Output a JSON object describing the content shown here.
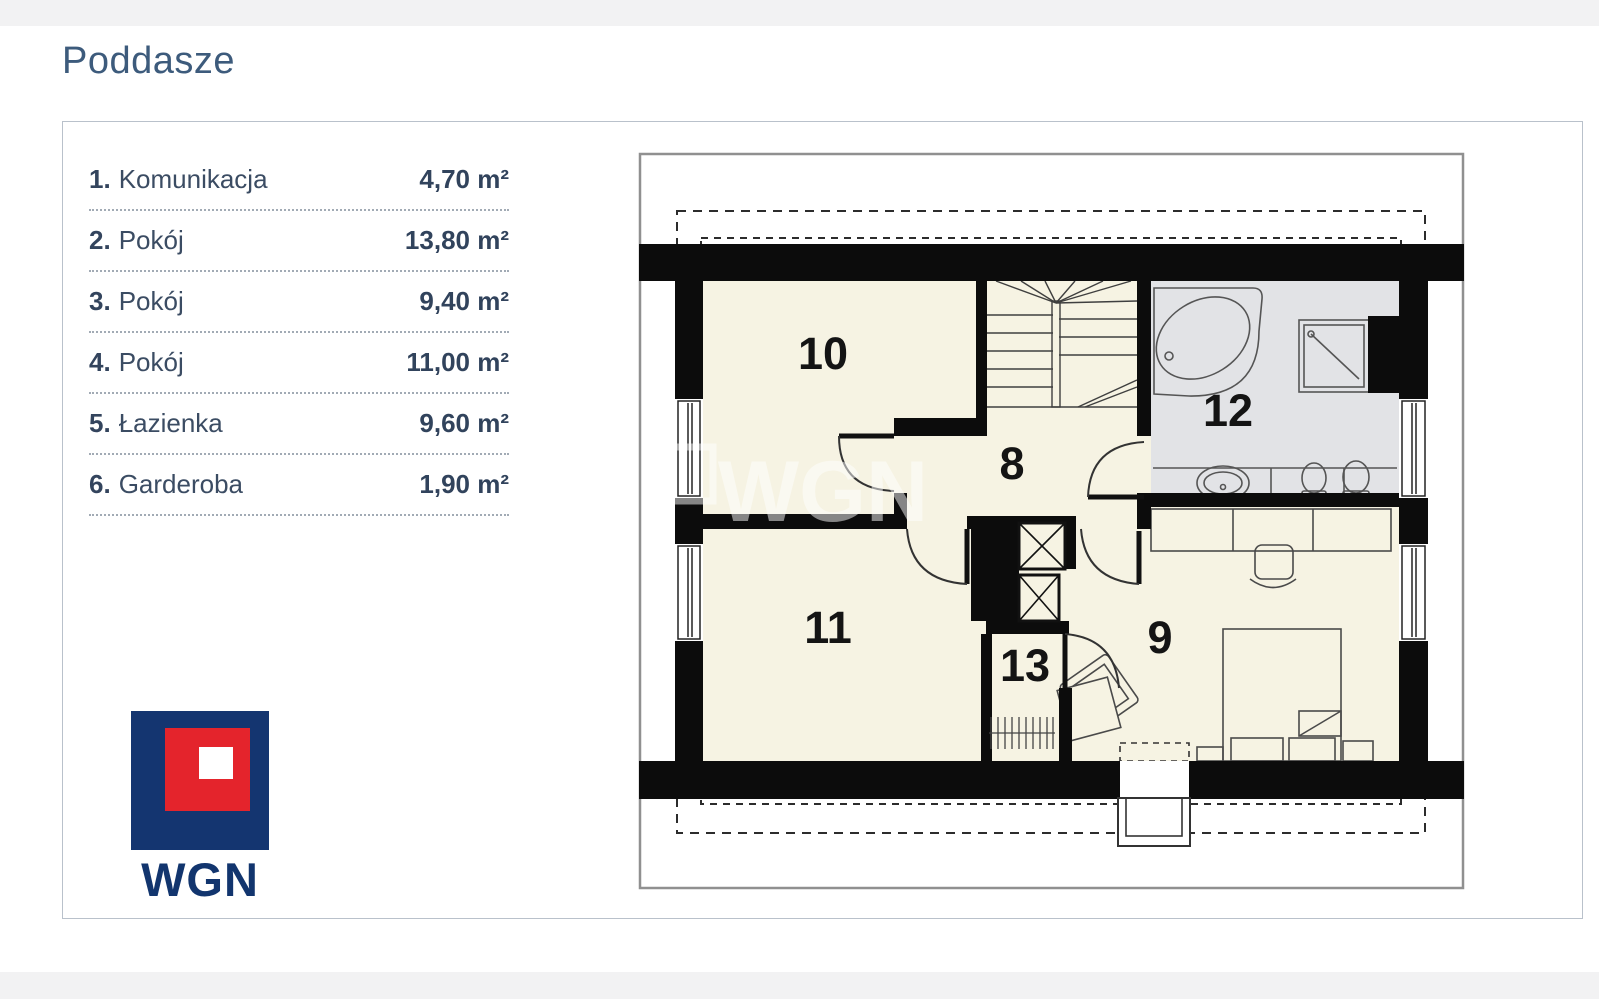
{
  "page": {
    "title": "Poddasze",
    "background": "#ffffff",
    "strip_color": "#f2f2f3"
  },
  "legend": {
    "items": [
      {
        "no": "1.",
        "label": "Komunikacja",
        "area": "4,70 m²"
      },
      {
        "no": "2.",
        "label": "Pokój",
        "area": "13,80 m²"
      },
      {
        "no": "3.",
        "label": "Pokój",
        "area": "9,40 m²"
      },
      {
        "no": "4.",
        "label": "Pokój",
        "area": "11,00 m²"
      },
      {
        "no": "5.",
        "label": "Łazienka",
        "area": "9,60 m²"
      },
      {
        "no": "6.",
        "label": "Garderoba",
        "area": "1,90 m²"
      }
    ]
  },
  "logo": {
    "text": "WGN",
    "navy": "#143570",
    "red": "#e4242c"
  },
  "floorplan": {
    "watermark": "WGN",
    "room_labels": {
      "r8": "8",
      "r9": "9",
      "r10": "10",
      "r11": "11",
      "r12": "12",
      "r13": "13"
    },
    "colors": {
      "wall": "#0c0c0c",
      "floor": "#f6f3e3",
      "bathroom_floor": "#e2e3e6",
      "plan_border": "#909090"
    }
  }
}
